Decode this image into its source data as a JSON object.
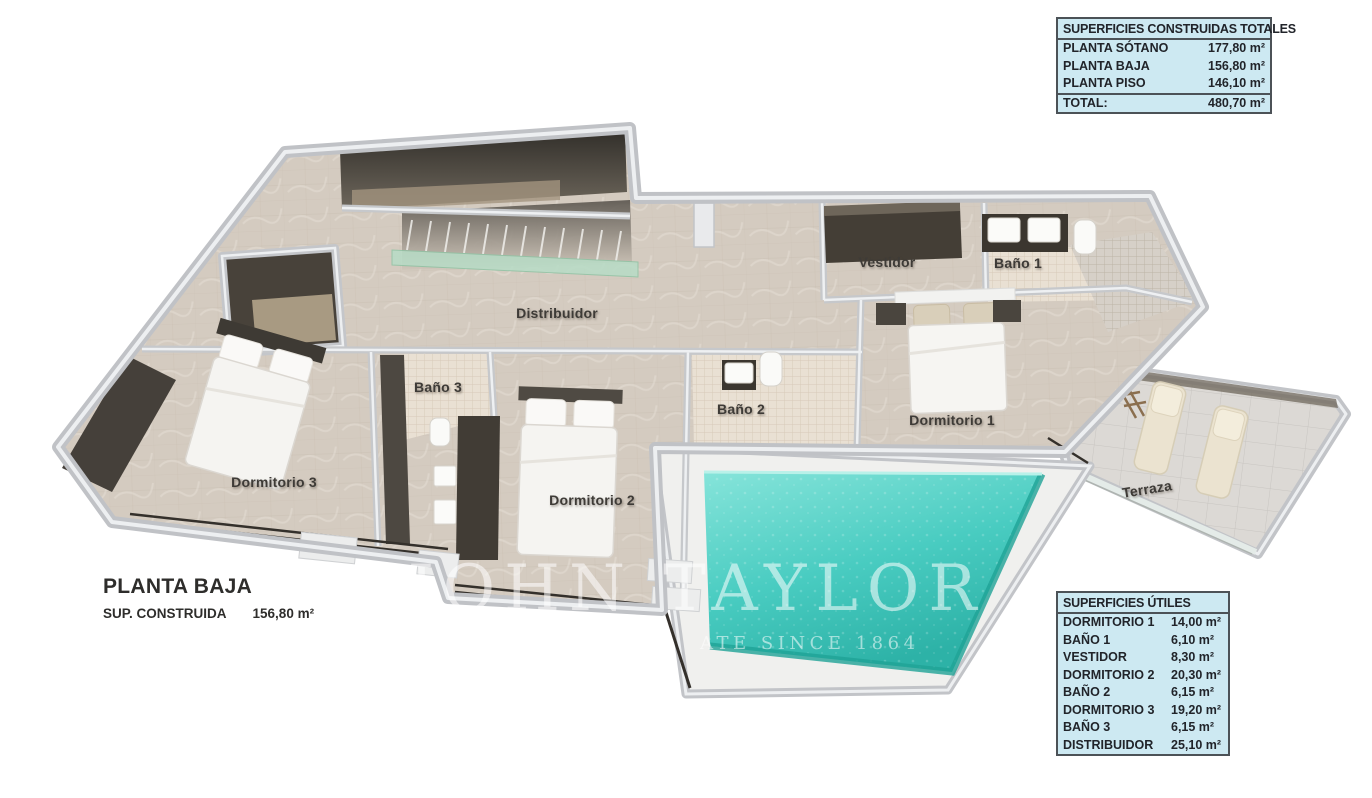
{
  "title_block": {
    "title": "PLANTA BAJA",
    "area_label": "SUP. CONSTRUIDA",
    "area_value": "156,80 m²"
  },
  "built_areas_table": {
    "header": "SUPERFICIES CONSTRUIDAS TOTALES",
    "rows": [
      {
        "label": "PLANTA SÓTANO",
        "value": "177,80 m²"
      },
      {
        "label": "PLANTA BAJA",
        "value": "156,80 m²"
      },
      {
        "label": "PLANTA PISO",
        "value": "146,10 m²"
      }
    ],
    "total": {
      "label": "TOTAL:",
      "value": "480,70 m²"
    }
  },
  "useful_areas_table": {
    "header": "SUPERFICIES ÚTILES",
    "rows": [
      {
        "label": "DORMITORIO 1",
        "value": "14,00 m²"
      },
      {
        "label": "BAÑO 1",
        "value": "6,10 m²"
      },
      {
        "label": "VESTIDOR",
        "value": "8,30 m²"
      },
      {
        "label": "DORMITORIO 2",
        "value": "20,30 m²"
      },
      {
        "label": "BAÑO 2",
        "value": "6,15 m²"
      },
      {
        "label": "DORMITORIO 3",
        "value": "19,20 m²"
      },
      {
        "label": "BAÑO 3",
        "value": "6,15 m²"
      },
      {
        "label": "DISTRIBUIDOR",
        "value": "25,10 m²"
      }
    ]
  },
  "room_labels": {
    "distribuidor": "Distribuidor",
    "vestidor": "Vestidor",
    "bano1": "Baño 1",
    "bano2": "Baño 2",
    "bano3": "Baño 3",
    "dormitorio1": "Dormitorio 1",
    "dormitorio2": "Dormitorio 2",
    "dormitorio3": "Dormitorio 3",
    "terraza": "Terraza"
  },
  "watermark": {
    "line1": "JOHN TAYLOR",
    "line2": "ATE SINCE 1864"
  },
  "colors": {
    "table_background": "#cde9f2",
    "table_border": "#4c5257",
    "pool_water": "#40c8bd",
    "floor_marble": "#d4cbc0",
    "wall_gray": "#c6c8cb",
    "dark_wood": "#46413a",
    "stair_glass": "#b7dcc6"
  }
}
